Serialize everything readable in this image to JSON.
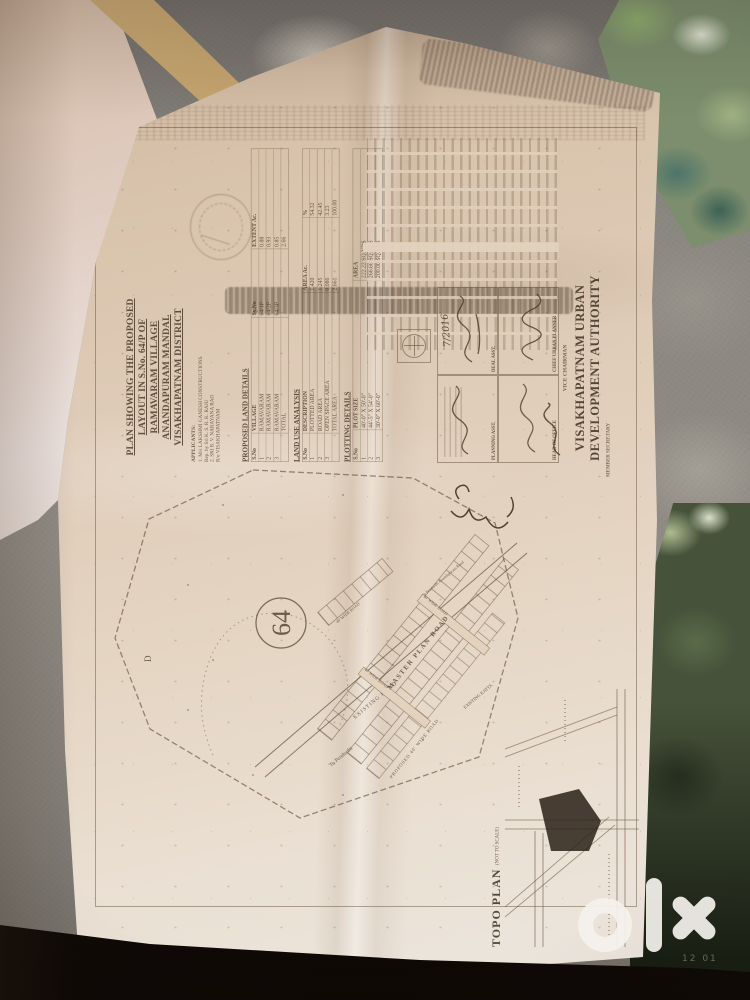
{
  "colors": {
    "paper_mid": "#e0cdb8",
    "ink": "#6f5d47",
    "fabric_grey": "#8b8781",
    "floral_green": "#9fb183",
    "floral_teal": "#4d746a",
    "fabric_green_dark": "#46523a",
    "cushion_tan": "#c2a26c",
    "floor_shadow": "#170f09",
    "pen_ink": "#4a3a28",
    "watermark_white": "#f4f1ec"
  },
  "watermark": {
    "brand": "olx",
    "subtext": "12 01"
  },
  "plan": {
    "title_lines": [
      "PLAN SHOWING THE PROPOSED",
      "LAYOUT IN S.No. 64/P OF",
      "RAMAVARAM VILLAGE",
      "ANANDAPURAM MANDAL",
      "VISAKHAPATNAM DISTRICT"
    ],
    "applicants": {
      "heading": "APPLICANTS:",
      "lines": [
        "1. M/s LAKSHMI GANESH CONSTRUCTIONS",
        "Rep. by Sri K. S. R. K. RAJU",
        "2. SRI B. V. NARAYANA RAO",
        "R/o VISAKHAPATNAM"
      ]
    },
    "land_details_heading": "PROPOSED LAND DETAILS",
    "survey_table": {
      "rows": [
        [
          "S.No",
          "VILLAGE",
          "Sy.No",
          "EXTENT Ac."
        ],
        [
          "1",
          "RAMAVARAM",
          "64/1P",
          "0.88"
        ],
        [
          "2",
          "RAMAVARAM",
          "64/2P",
          "0.93"
        ],
        [
          "3",
          "RAMAVARAM",
          "64/3P",
          "0.85"
        ],
        [
          "",
          "TOTAL",
          "",
          "2.66"
        ]
      ]
    },
    "land_use_table": {
      "title": "LAND USE ANALYSIS",
      "rows": [
        [
          "S.No",
          "DESCRIPTION",
          "AREA Ac.",
          "%"
        ],
        [
          "1",
          "PLOTTED AREA",
          "1.420",
          "54.32"
        ],
        [
          "2",
          "ROAD AREA",
          "1.245",
          "42.45"
        ],
        [
          "3",
          "OPEN SPACE AREA",
          "0.086",
          "3.23"
        ],
        [
          "",
          "TOTAL AREA",
          "2.661",
          "100.00"
        ]
      ]
    },
    "plotting_table": {
      "title": "PLOTTING DETAILS",
      "rows": [
        [
          "S.No",
          "PLOT SIZE",
          "AREA"
        ],
        [
          "1",
          "40'-0\" X 50'-0\"",
          "222.22 SQ.YDS"
        ],
        [
          "2",
          "44'-5\" X 54'-0\"",
          "266.66 SQ.YDS"
        ],
        [
          "3",
          "30'-0\" X 60'-0\"",
          "200.00 SQ.YDS"
        ]
      ]
    },
    "approval": {
      "date": "7/2016",
      "boxes": [
        "PLANNING ASST.",
        "DEAL ASST.",
        "HEAD OF OFFICE",
        "CHIEF URBAN PLANNER"
      ]
    },
    "authority": {
      "member_secretary": "MEMBER SECRETARY",
      "vice_chairman": "VICE CHAIRMAN",
      "line1": "VISAKHAPATNAM URBAN",
      "line2": "DEVELOPMENT AUTHORITY"
    },
    "map": {
      "parcel_number": "64",
      "zone_letter": "D",
      "labels": {
        "master_road": "MASTER PLAN ROAD",
        "wide_road_1": "40' WIDE ROAD",
        "wide_road_2": "40' WIDE ROAD",
        "wide_road_3": "40' WIDE ROAD",
        "proposed_road": "PROPOSED 40' WIDE ROAD",
        "existing_road": "EXISTING ROAD",
        "to_pendurthi": "To Pendurthi",
        "anandapuram_road": "To Pendurthi Anandapuram Road",
        "existing_katta": "EXISTING KATTA"
      }
    },
    "topo": {
      "title": "TOPO PLAN",
      "scale": "(NOT TO SCALE)"
    }
  }
}
